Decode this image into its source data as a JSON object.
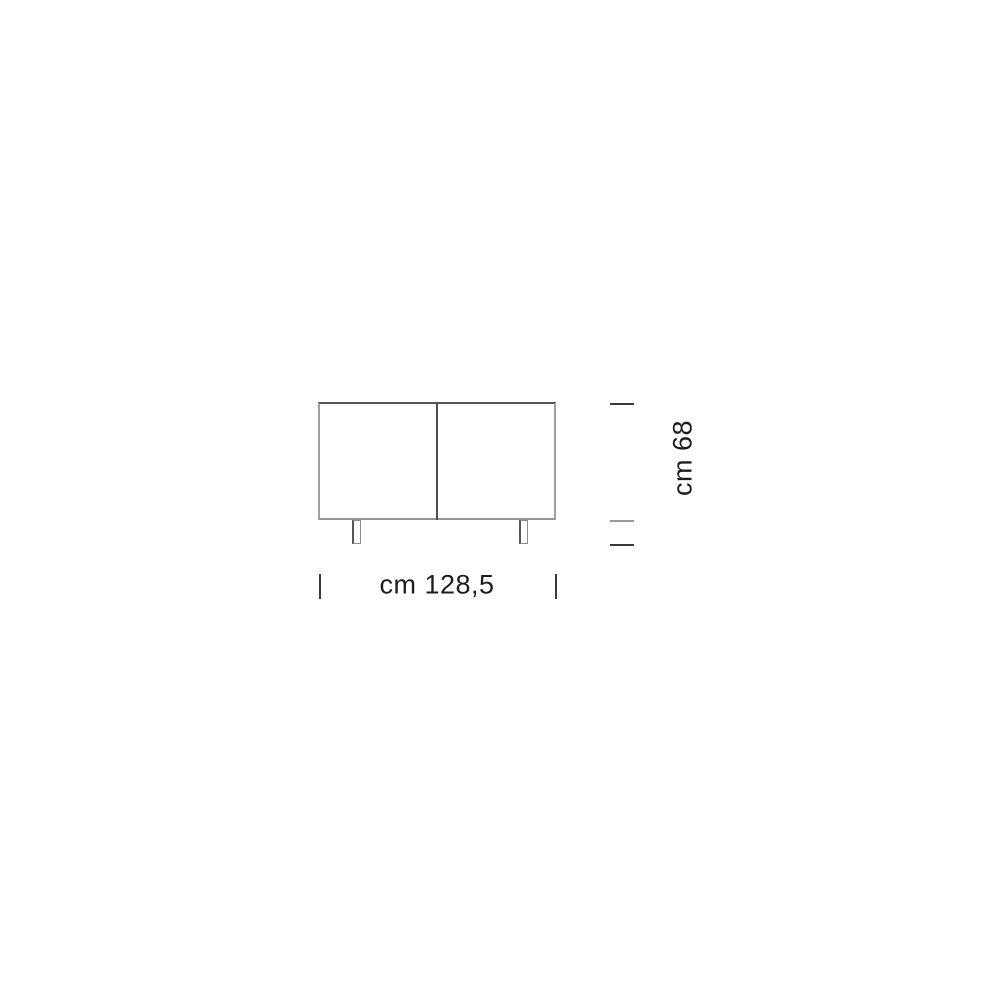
{
  "diagram": {
    "kind": "furniture-dimension-drawing",
    "view": "sideboard front elevation, two doors, two legs",
    "labels": {
      "width": "cm 128,5",
      "height": "cm 68"
    },
    "dimensions": {
      "width_cm": 128.5,
      "height_cm": 68
    },
    "colors": {
      "background": "#ffffff",
      "outline_dark": "#565656",
      "outline_mid": "#949494",
      "outline_light": "#a0a0a0",
      "divider": "#4f4f4f",
      "leg_stroke": "#8f8f8f",
      "leg_stroke_dark": "#585858",
      "tick_dark": "#3a3a3a",
      "tick_light": "#9b9b9b",
      "text": "#1d1d1d"
    }
  }
}
